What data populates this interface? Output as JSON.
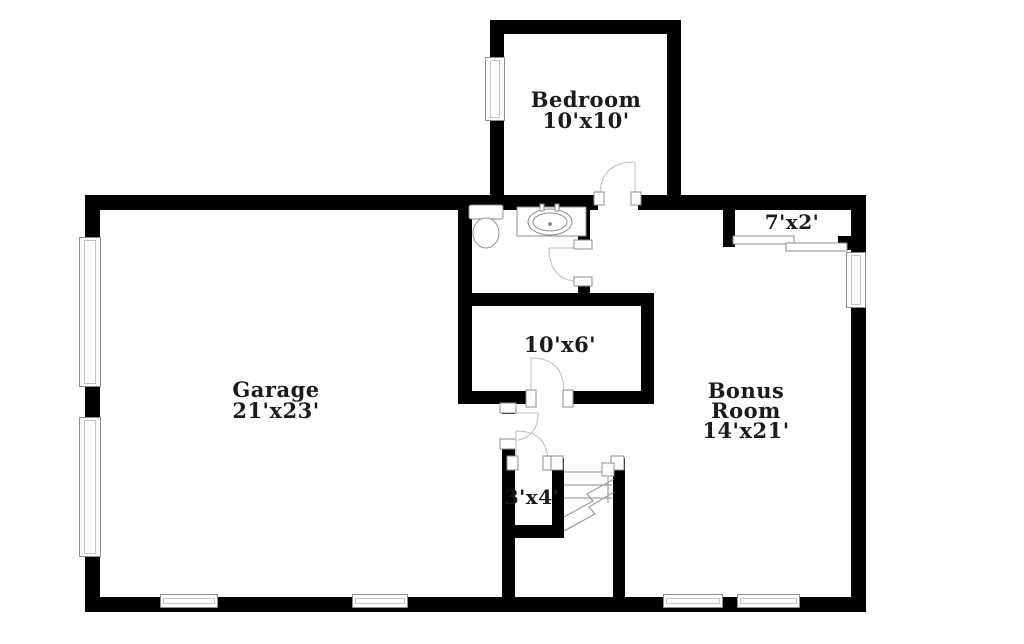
{
  "colors": {
    "wall": "#000000",
    "symbol_stroke": "#8d8d8d",
    "door_arc": "#bdbdbd",
    "text": "#1b1b1b",
    "background": "#ffffff"
  },
  "rooms": {
    "bedroom": {
      "name": "Bedroom",
      "size": "10'x10'"
    },
    "garage": {
      "name": "Garage",
      "size": "21'x23'"
    },
    "hall_room": {
      "size": "10'x6'"
    },
    "bonus": {
      "line1": "Bonus",
      "line2": "Room",
      "size": "14'x21'"
    },
    "top_closet": {
      "size": "7'x2'"
    },
    "stair_closet": {
      "size": "3'x4'"
    }
  }
}
